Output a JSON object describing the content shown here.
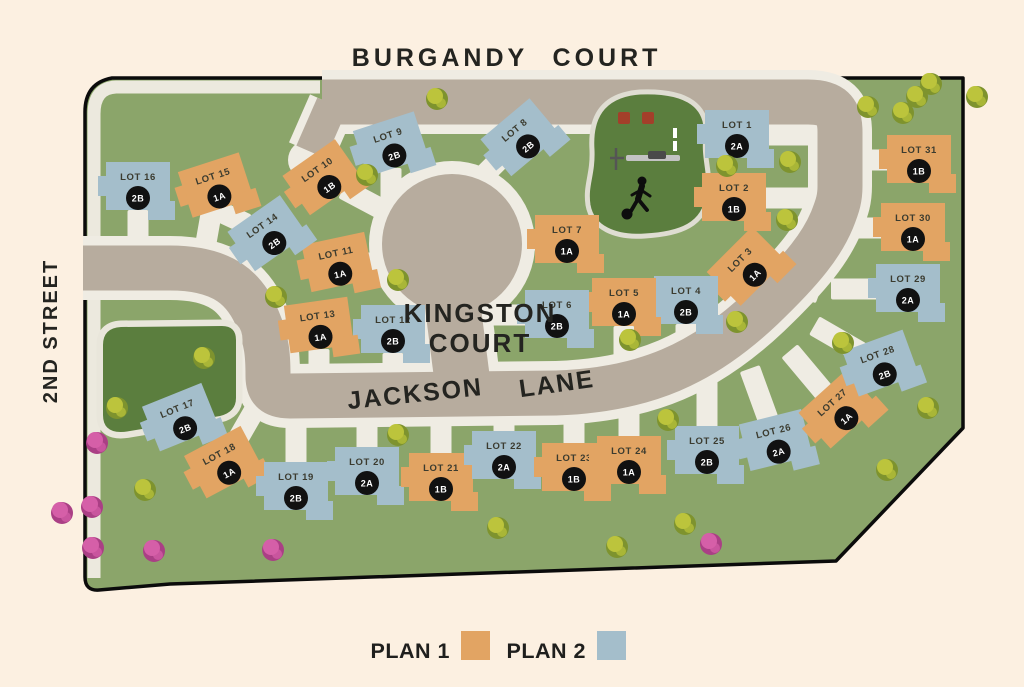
{
  "streets": {
    "burgandy": "BURGANDY",
    "court": "COURT",
    "second_street": "2ND STREET",
    "kingston_line1": "KINGSTON",
    "kingston_line2": "COURT",
    "jackson": "JACKSON",
    "lane": "LANE"
  },
  "legend": {
    "plan1_label": "PLAN 1",
    "plan1_color": "#e2a463",
    "plan2_label": "PLAN 2",
    "plan2_color": "#a4becb"
  },
  "colors": {
    "background": "#fcf0e1",
    "land_green": "#8ba56a",
    "park_green": "#5b7e3e",
    "road": "#b7ac9e",
    "sidewalk": "#efece3",
    "boundary": "#0b0b0b",
    "plan1": "#e2a463",
    "plan2": "#a4becb",
    "badge": "#111111",
    "lot_text": "#3b3b2f",
    "tree_green_dark": "#7e932e",
    "tree_green_light": "#bcc43c",
    "tree_pink_dark": "#aa3f85",
    "tree_pink_light": "#d55fa8"
  },
  "lots": [
    {
      "lot": "LOT 1",
      "plan": "2A",
      "plan_type": 2,
      "x": 737,
      "y": 135,
      "rot": 0,
      "drive": 0
    },
    {
      "lot": "LOT 2",
      "plan": "1B",
      "plan_type": 1,
      "x": 734,
      "y": 198,
      "rot": 0,
      "drive": 0
    },
    {
      "lot": "LOT 3",
      "plan": "1A",
      "plan_type": 1,
      "x": 747,
      "y": 267,
      "rot": -45,
      "drive": 20
    },
    {
      "lot": "LOT 4",
      "plan": "2B",
      "plan_type": 2,
      "x": 686,
      "y": 301,
      "rot": 0,
      "drive": 90
    },
    {
      "lot": "LOT 5",
      "plan": "1A",
      "plan_type": 1,
      "x": 624,
      "y": 303,
      "rot": 0,
      "drive": 90
    },
    {
      "lot": "LOT 6",
      "plan": "2B",
      "plan_type": 2,
      "x": 557,
      "y": 315,
      "rot": 0,
      "drive": 180
    },
    {
      "lot": "LOT 7",
      "plan": "1A",
      "plan_type": 1,
      "x": 567,
      "y": 240,
      "rot": 0,
      "drive": 180
    },
    {
      "lot": "LOT 8",
      "plan": "2B",
      "plan_type": 2,
      "x": 521,
      "y": 138,
      "rot": -40,
      "drive": 135
    },
    {
      "lot": "LOT 9",
      "plan": "2B",
      "plan_type": 2,
      "x": 391,
      "y": 145,
      "rot": -18,
      "drive": 90
    },
    {
      "lot": "LOT 10",
      "plan": "1B",
      "plan_type": 1,
      "x": 323,
      "y": 178,
      "rot": -35,
      "drive": 28
    },
    {
      "lot": "LOT 11",
      "plan": "1A",
      "plan_type": 1,
      "x": 338,
      "y": 263,
      "rot": -12,
      "drive": 0
    },
    {
      "lot": "LOT 12",
      "plan": "2B",
      "plan_type": 2,
      "x": 393,
      "y": 330,
      "rot": 0,
      "drive": 90
    },
    {
      "lot": "LOT 13",
      "plan": "1A",
      "plan_type": 1,
      "x": 319,
      "y": 326,
      "rot": -8,
      "drive": 90
    },
    {
      "lot": "LOT 14",
      "plan": "2B",
      "plan_type": 2,
      "x": 268,
      "y": 234,
      "rot": -35,
      "drive": 205
    },
    {
      "lot": "LOT 15",
      "plan": "1A",
      "plan_type": 1,
      "x": 216,
      "y": 186,
      "rot": -18,
      "drive": 100
    },
    {
      "lot": "LOT 16",
      "plan": "2B",
      "plan_type": 2,
      "x": 138,
      "y": 187,
      "rot": 0,
      "drive": 90
    },
    {
      "lot": "LOT 17",
      "plan": "2B",
      "plan_type": 2,
      "x": 181,
      "y": 418,
      "rot": -22,
      "drive": 320
    },
    {
      "lot": "LOT 18",
      "plan": "1A",
      "plan_type": 1,
      "x": 224,
      "y": 463,
      "rot": -28,
      "drive": 300
    },
    {
      "lot": "LOT 19",
      "plan": "2B",
      "plan_type": 2,
      "x": 296,
      "y": 487,
      "rot": 0,
      "drive": 270
    },
    {
      "lot": "LOT 20",
      "plan": "2A",
      "plan_type": 2,
      "x": 367,
      "y": 472,
      "rot": 0,
      "drive": 270
    },
    {
      "lot": "LOT 21",
      "plan": "1B",
      "plan_type": 1,
      "x": 441,
      "y": 478,
      "rot": 0,
      "drive": 270
    },
    {
      "lot": "LOT 22",
      "plan": "2A",
      "plan_type": 2,
      "x": 504,
      "y": 456,
      "rot": 0,
      "drive": 270
    },
    {
      "lot": "LOT 23",
      "plan": "1B",
      "plan_type": 1,
      "x": 574,
      "y": 468,
      "rot": 0,
      "drive": 270
    },
    {
      "lot": "LOT 24",
      "plan": "1A",
      "plan_type": 1,
      "x": 629,
      "y": 461,
      "rot": 0,
      "drive": 270
    },
    {
      "lot": "LOT 25",
      "plan": "2B",
      "plan_type": 2,
      "x": 707,
      "y": 451,
      "rot": 0,
      "drive": 270
    },
    {
      "lot": "LOT 26",
      "plan": "2A",
      "plan_type": 2,
      "x": 776,
      "y": 441,
      "rot": -14,
      "drive": 250
    },
    {
      "lot": "LOT 27",
      "plan": "1A",
      "plan_type": 1,
      "x": 839,
      "y": 410,
      "rot": -42,
      "drive": 230
    },
    {
      "lot": "LOT 28",
      "plan": "2B",
      "plan_type": 2,
      "x": 881,
      "y": 364,
      "rot": -20,
      "drive": 210
    },
    {
      "lot": "LOT 29",
      "plan": "2A",
      "plan_type": 2,
      "x": 908,
      "y": 289,
      "rot": 0,
      "drive": 180
    },
    {
      "lot": "LOT 30",
      "plan": "1A",
      "plan_type": 1,
      "x": 913,
      "y": 228,
      "rot": 0,
      "drive": 180
    },
    {
      "lot": "LOT 31",
      "plan": "1B",
      "plan_type": 1,
      "x": 919,
      "y": 160,
      "rot": 0,
      "drive": 180
    }
  ],
  "trees": [
    {
      "x": 437,
      "y": 99,
      "kind": "green"
    },
    {
      "x": 367,
      "y": 175,
      "kind": "green"
    },
    {
      "x": 398,
      "y": 280,
      "kind": "green"
    },
    {
      "x": 276,
      "y": 297,
      "kind": "green"
    },
    {
      "x": 204,
      "y": 358,
      "kind": "green"
    },
    {
      "x": 117,
      "y": 408,
      "kind": "green"
    },
    {
      "x": 145,
      "y": 490,
      "kind": "green"
    },
    {
      "x": 398,
      "y": 435,
      "kind": "green"
    },
    {
      "x": 498,
      "y": 528,
      "kind": "green"
    },
    {
      "x": 617,
      "y": 547,
      "kind": "green"
    },
    {
      "x": 685,
      "y": 524,
      "kind": "green"
    },
    {
      "x": 630,
      "y": 340,
      "kind": "green"
    },
    {
      "x": 737,
      "y": 322,
      "kind": "green"
    },
    {
      "x": 668,
      "y": 420,
      "kind": "green"
    },
    {
      "x": 787,
      "y": 220,
      "kind": "green"
    },
    {
      "x": 790,
      "y": 162,
      "kind": "green"
    },
    {
      "x": 727,
      "y": 166,
      "kind": "green"
    },
    {
      "x": 843,
      "y": 343,
      "kind": "green"
    },
    {
      "x": 928,
      "y": 408,
      "kind": "green"
    },
    {
      "x": 887,
      "y": 470,
      "kind": "green"
    },
    {
      "x": 903,
      "y": 113,
      "kind": "green"
    },
    {
      "x": 917,
      "y": 97,
      "kind": "green"
    },
    {
      "x": 931,
      "y": 84,
      "kind": "green"
    },
    {
      "x": 977,
      "y": 97,
      "kind": "green"
    },
    {
      "x": 868,
      "y": 107,
      "kind": "green"
    },
    {
      "x": 97,
      "y": 443,
      "kind": "pink"
    },
    {
      "x": 92,
      "y": 507,
      "kind": "pink"
    },
    {
      "x": 93,
      "y": 548,
      "kind": "pink"
    },
    {
      "x": 154,
      "y": 551,
      "kind": "pink"
    },
    {
      "x": 273,
      "y": 550,
      "kind": "pink"
    },
    {
      "x": 711,
      "y": 544,
      "kind": "pink"
    },
    {
      "x": 62,
      "y": 513,
      "kind": "pink"
    }
  ]
}
